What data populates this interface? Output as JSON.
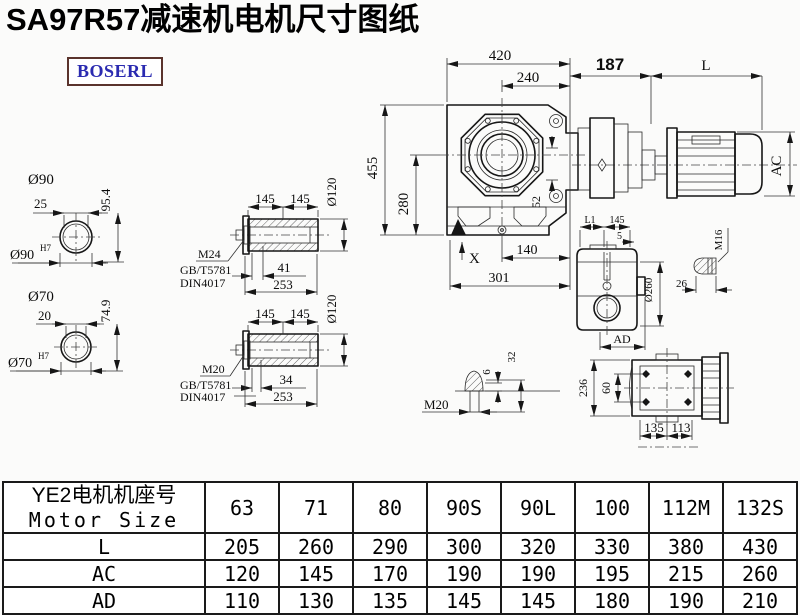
{
  "title": "SA97R57减速机电机尺寸图纸",
  "logo": "BOSERL",
  "views": {
    "shaft90": {
      "name": "Ø90",
      "width": "25",
      "height": "95.4",
      "bore": "Ø90",
      "bore_tol": "H7"
    },
    "shaft70": {
      "name": "Ø70",
      "width": "20",
      "height": "74.9",
      "bore": "Ø70",
      "bore_tol": "H7"
    },
    "hollow_top": {
      "len_a": "145",
      "len_b": "145",
      "dia": "Ø120",
      "thread": "M24",
      "std1": "GB/T5781",
      "std2": "DIN4017",
      "depth": "41",
      "total": "253"
    },
    "hollow_bottom": {
      "len_a": "145",
      "len_b": "145",
      "dia": "Ø120",
      "thread": "M20",
      "std1": "GB/T5781",
      "std2": "DIN4017",
      "depth": "34",
      "total": "253"
    },
    "front": {
      "width": "420",
      "half_width": "240",
      "height": "455",
      "center_height": "280",
      "offset": "52",
      "x_mark": "X",
      "foot_a": "140",
      "foot_b": "301"
    },
    "motor": {
      "adapter": "187",
      "length": "L",
      "diameter": "AC"
    },
    "side": {
      "l1": "L1",
      "len": "145",
      "gap": "5",
      "flange_dia": "Ø260",
      "ad": "AD"
    },
    "bolt_m16": {
      "thread": "M16",
      "len": "26"
    },
    "bolt_m20": {
      "thread": "M20",
      "tip": "6",
      "len": "32"
    },
    "rear": {
      "height": "236",
      "bolt_span": "60",
      "foot_a": "135",
      "foot_b": "113"
    }
  },
  "table": {
    "header_cn": "YE2电机机座号",
    "header_en": "Motor Size",
    "sizes": [
      "63",
      "71",
      "80",
      "90S",
      "90L",
      "100",
      "112M",
      "132S"
    ],
    "rows": [
      {
        "label": "L",
        "values": [
          "205",
          "260",
          "290",
          "300",
          "320",
          "330",
          "380",
          "430"
        ]
      },
      {
        "label": "AC",
        "values": [
          "120",
          "145",
          "170",
          "190",
          "190",
          "195",
          "215",
          "260"
        ]
      },
      {
        "label": "AD",
        "values": [
          "110",
          "130",
          "135",
          "145",
          "145",
          "180",
          "190",
          "210"
        ]
      }
    ]
  }
}
